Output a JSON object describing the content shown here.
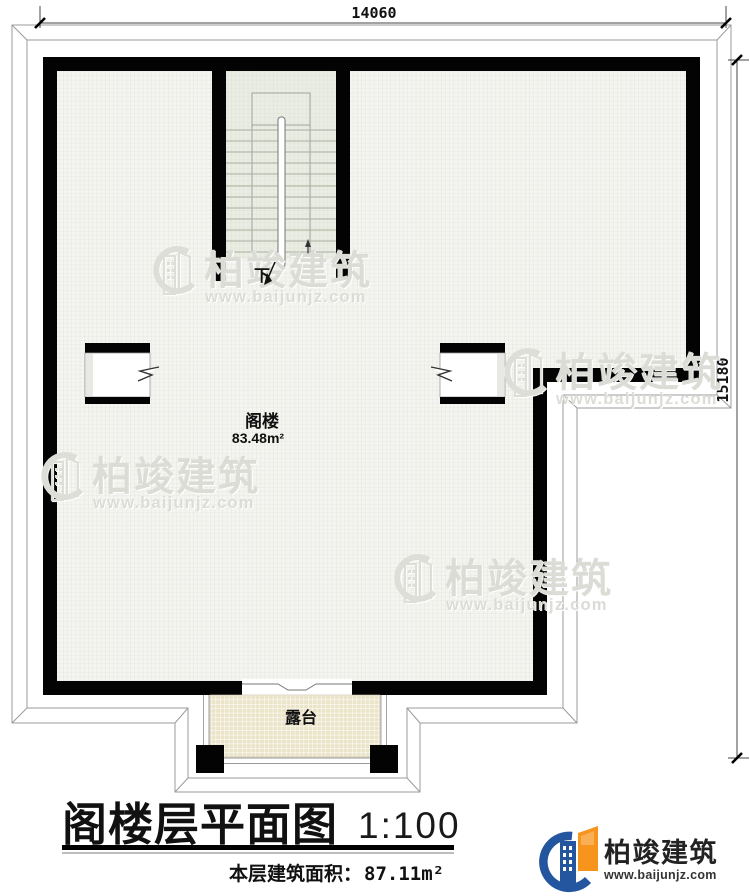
{
  "plan": {
    "dim_top": "14060",
    "dim_right": "15180",
    "stair_down_label": "下",
    "attic_name": "阁楼",
    "attic_area": "83.48m²",
    "terrace_name": "露台"
  },
  "watermark": {
    "brand": "柏竣建筑",
    "url": "www.baijunjz.com"
  },
  "title_block": {
    "title": "阁楼层平面图",
    "scale": "1:100",
    "area_label": "本层建筑面积：",
    "area_value": "87.11m²"
  },
  "logo": {
    "brand": "柏竣建筑",
    "url": "www.baijunjz.com"
  },
  "colors": {
    "wall": "#000000",
    "floor": "#f4f4f1",
    "stair_floor": "#eaede3",
    "terrace_floor": "#ebe4c9",
    "logo_blue": "#2456a0",
    "logo_orange": "#f7941d"
  }
}
